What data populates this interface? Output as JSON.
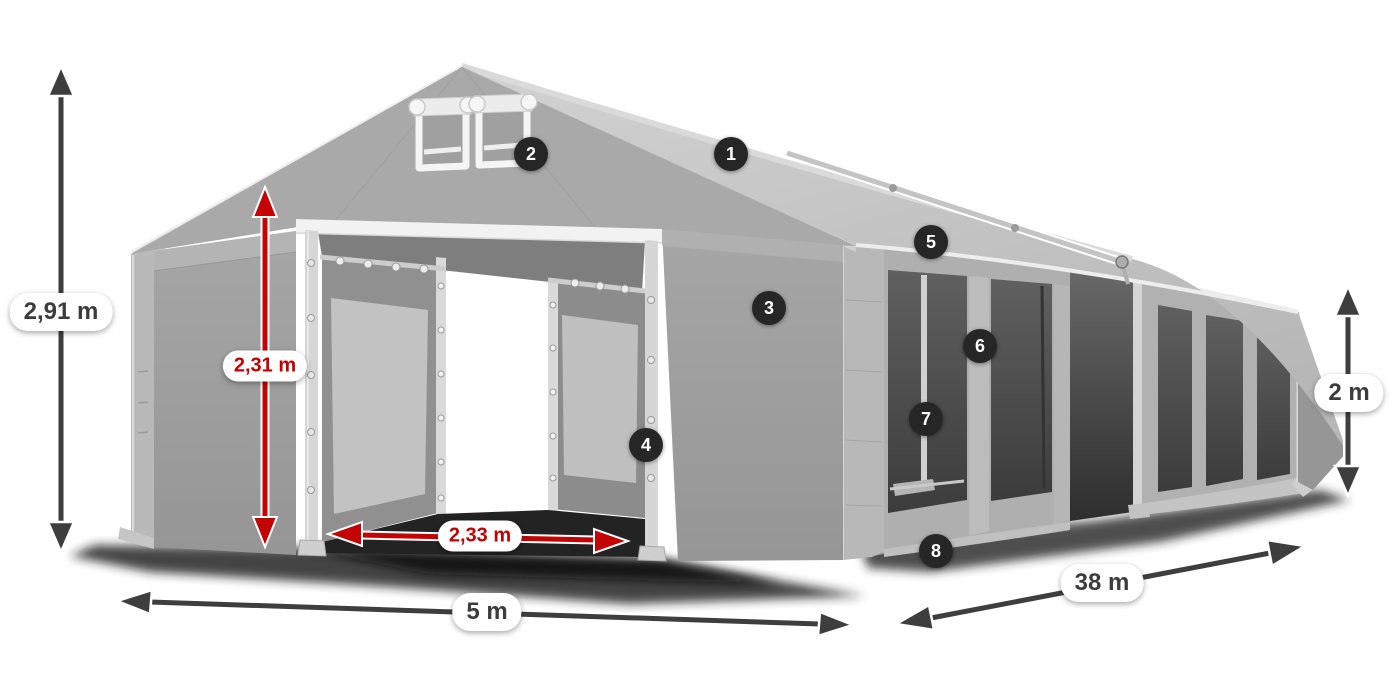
{
  "diagram": {
    "subject": "marquee-tent-dimension-diagram",
    "dimension_labels": [
      {
        "id": "total-height",
        "text": "2,91 m",
        "style": "dark"
      },
      {
        "id": "entrance-height",
        "text": "2,31 m",
        "style": "red"
      },
      {
        "id": "entrance-width",
        "text": "2,33 m",
        "style": "red"
      },
      {
        "id": "tent-width",
        "text": "5 m",
        "style": "dark"
      },
      {
        "id": "tent-length",
        "text": "38 m",
        "style": "dark"
      },
      {
        "id": "side-wall-height",
        "text": "2 m",
        "style": "dark"
      }
    ],
    "callouts": [
      {
        "number": "1"
      },
      {
        "number": "2"
      },
      {
        "number": "3"
      },
      {
        "number": "4"
      },
      {
        "number": "5"
      },
      {
        "number": "6"
      },
      {
        "number": "7"
      },
      {
        "number": "8"
      }
    ],
    "colors": {
      "accent_red": "#c40404",
      "arrow_dark": "#3e3e3e",
      "badge_bg": "#262626",
      "badge_text": "#ffffff",
      "label_bg": "#ffffff",
      "label_text": "#3c3c3c",
      "tent_roof": "#c9c9c9",
      "tent_wall": "#a6a6a6",
      "tent_window": "#4a4a4a",
      "frame_white": "#f2f2f2"
    }
  }
}
